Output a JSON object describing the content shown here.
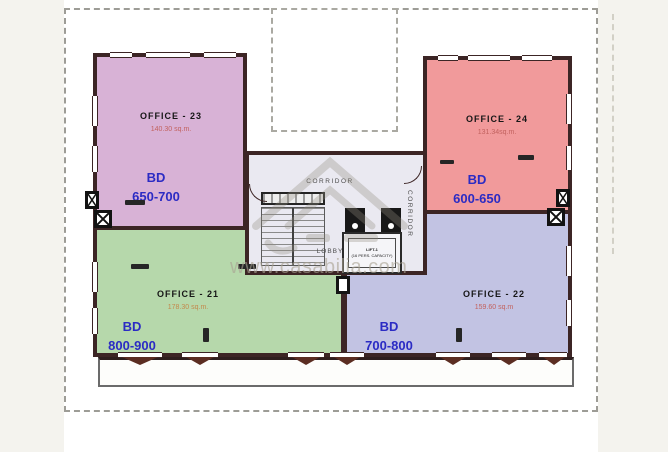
{
  "watermark": {
    "url_text": "www.casabilia.com"
  },
  "offices": {
    "o23": {
      "label": "OFFICE - 23",
      "area": "140.30 sq.m.",
      "currency": "BD",
      "price_range": "650-700",
      "fill": "#d8b2d6"
    },
    "o24": {
      "label": "OFFICE - 24",
      "area": "131.34sq.m.",
      "currency": "BD",
      "price_range": "600-650",
      "fill": "#f19a9b"
    },
    "o21": {
      "label": "OFFICE - 21",
      "area": "178.30 sq.m.",
      "currency": "BD",
      "price_range": "800-900",
      "fill": "#b6d8ab"
    },
    "o22": {
      "label": "OFFICE - 22",
      "area": "159.60 sq.m",
      "currency": "BD",
      "price_range": "700-800",
      "fill": "#c2c3e3"
    }
  },
  "core": {
    "corridor_top_label": "CORRIDOR",
    "corridor_right_label": "CORRIDOR",
    "lobby_label": "LOBBY",
    "lift_name": "LIFT-1",
    "lift_capacity": "(16 PERS. CAPACITY)"
  },
  "colors": {
    "wall": "#3c2525",
    "price_text": "#2b2bc4",
    "area_text": "#c2625f",
    "area_text_office21": "#c3894c",
    "core_fill": "#eae9f1",
    "outside_fill": "#f4f3ee",
    "boundary_dash": "#9d9c96",
    "window_sill": "#5b2d22"
  }
}
